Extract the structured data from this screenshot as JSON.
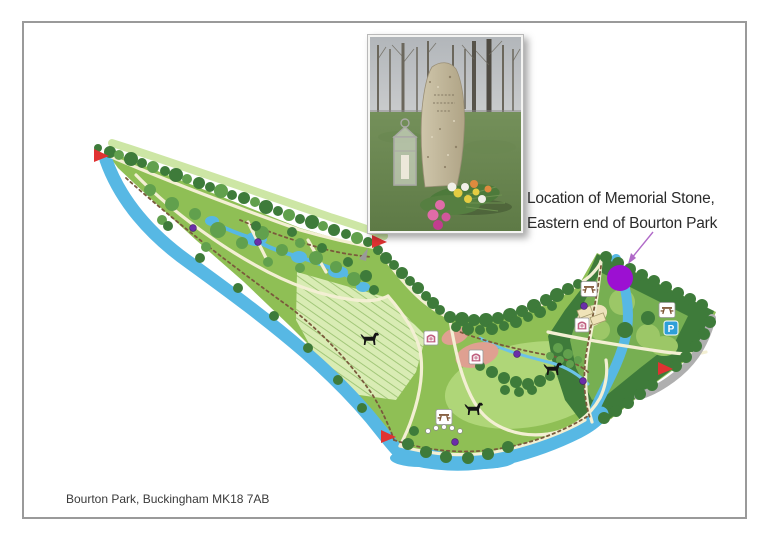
{
  "page": {
    "background": "#ffffff",
    "border_color": "#9a9a9a"
  },
  "caption": {
    "text": "Bourton Park, Buckingham MK18 7AB"
  },
  "annotation": {
    "line1": "Location of Memorial Stone,",
    "line2": "Eastern end of Bourton Park",
    "arrow_color": "#B06AC8"
  },
  "photo": {
    "name": "memorial-stone-photo"
  },
  "map": {
    "colors": {
      "land": "#8FBF55",
      "lawn": "#AFD678",
      "field_bg": "#D9ECB4",
      "field_line": "#A2C779",
      "trees_dark": "#3E7B3A",
      "trees_mid": "#61A04D",
      "water": "#57B8E4",
      "path_cream": "#F3EFD3",
      "trail_brown": "#7A5A3C",
      "playground": "#DFA091",
      "picnic_tan": "#EDE2BC",
      "road_grey": "#AFAFAF",
      "flag_red": "#E03232",
      "memorial_purple": "#9C10D2",
      "marker_purple": "#6B2EA8",
      "parking_blue": "#2E9FD8"
    },
    "memorial_marker": {
      "x": 620,
      "y": 278,
      "r": 13
    },
    "entrance_flags": [
      {
        "x": 94,
        "y": 156
      },
      {
        "x": 372,
        "y": 242
      },
      {
        "x": 381,
        "y": 437
      },
      {
        "x": 658,
        "y": 369
      }
    ],
    "dog_exercise_icons": [
      {
        "x": 370,
        "y": 339
      },
      {
        "x": 474,
        "y": 409
      },
      {
        "x": 553,
        "y": 369
      }
    ],
    "picnic_icons": [
      {
        "x": 589,
        "y": 289
      },
      {
        "x": 667,
        "y": 310
      },
      {
        "x": 444,
        "y": 417
      }
    ],
    "play_area_icons": [
      {
        "x": 431,
        "y": 338
      },
      {
        "x": 476,
        "y": 357
      },
      {
        "x": 582,
        "y": 325
      }
    ],
    "parking_icon": {
      "x": 671,
      "y": 328,
      "label": "P"
    },
    "waymarkers": [
      {
        "x": 193,
        "y": 228
      },
      {
        "x": 258,
        "y": 242
      },
      {
        "x": 517,
        "y": 354
      },
      {
        "x": 584,
        "y": 306
      },
      {
        "x": 583,
        "y": 381
      },
      {
        "x": 455,
        "y": 442
      }
    ],
    "stepping_stones": [
      {
        "x": 428,
        "y": 431
      },
      {
        "x": 436,
        "y": 428
      },
      {
        "x": 444,
        "y": 427
      },
      {
        "x": 452,
        "y": 428
      },
      {
        "x": 460,
        "y": 431
      }
    ]
  }
}
